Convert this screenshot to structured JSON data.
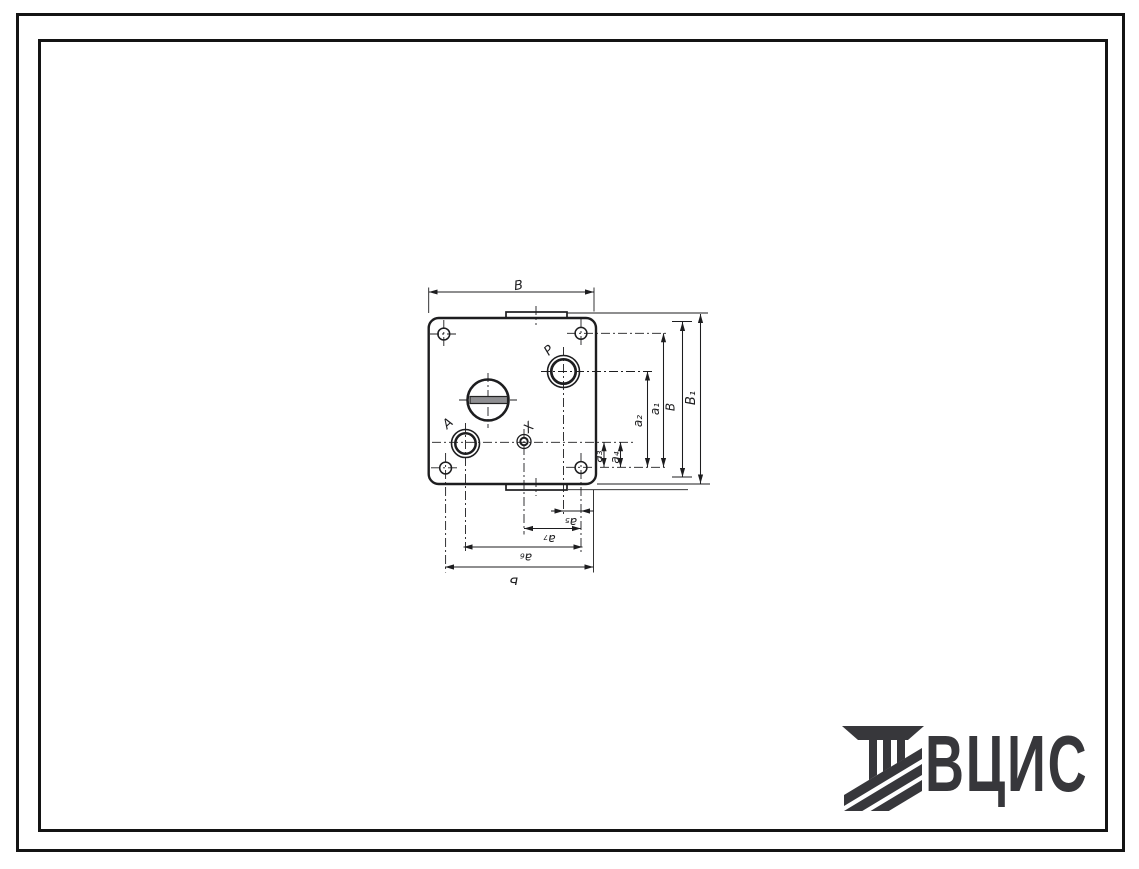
{
  "drawing": {
    "port_labels": {
      "a": "А",
      "p": "Р",
      "x": "Х"
    },
    "dim_labels": {
      "top_width": "В",
      "b1": "В₁",
      "b": "В",
      "a1": "а₁",
      "a2": "а₂",
      "a3": "а₃",
      "a4": "а₄",
      "a5": "а₅",
      "a6": "а₆",
      "a7": "а₇",
      "length": "Б"
    }
  },
  "logo": {
    "text": "ВЦИС"
  },
  "colors": {
    "ink": "#1d1d1f",
    "logo": "#37373b",
    "paper": "#ffffff"
  }
}
